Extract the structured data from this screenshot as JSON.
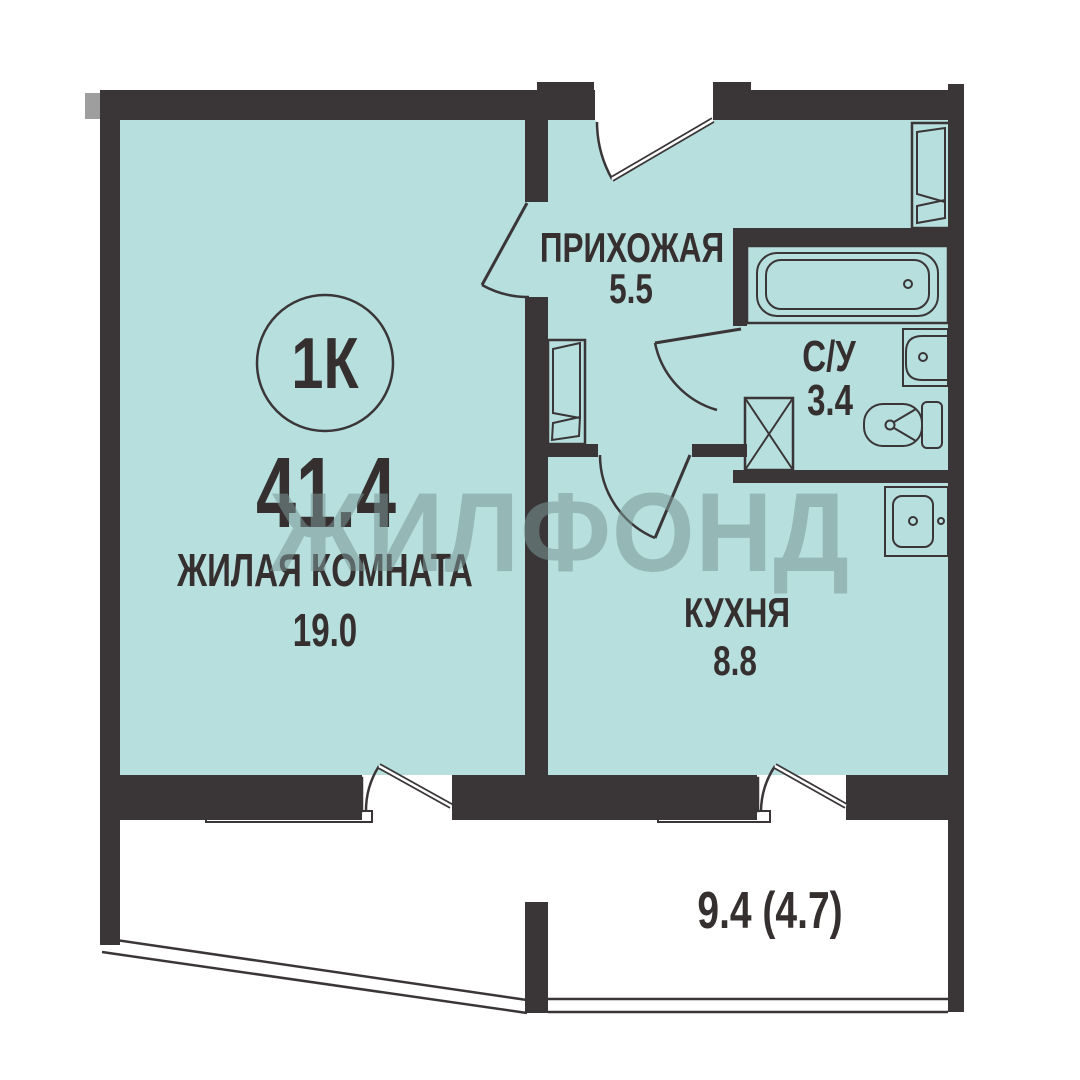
{
  "plan": {
    "badge": "1К",
    "total_area": "41.4",
    "watermark": "ЖИЛФОНД",
    "rooms": {
      "living": {
        "name": "ЖИЛАЯ КОМНАТА",
        "area": "19.0"
      },
      "hallway": {
        "name": "ПРИХОЖАЯ",
        "area": "5.5"
      },
      "bathroom": {
        "name": "С/У",
        "area": "3.4"
      },
      "kitchen": {
        "name": "КУХНЯ",
        "area": "8.8"
      },
      "balcony": {
        "area": "9.4 (4.7)"
      }
    },
    "fixtures": [
      "bathtub-icon",
      "washbasin-icon",
      "toilet-icon",
      "kitchen-sink-icon",
      "ventilation-shaft-icon",
      "wardrobe-icon",
      "entrance-door-icon",
      "interior-door-icon",
      "window-icon",
      "balcony-railing"
    ],
    "colors": {
      "wall": "#3a3637",
      "room_fill": "#b6dfdd",
      "background": "#ffffff",
      "text": "#35302f",
      "watermark": "#7a9795"
    }
  }
}
